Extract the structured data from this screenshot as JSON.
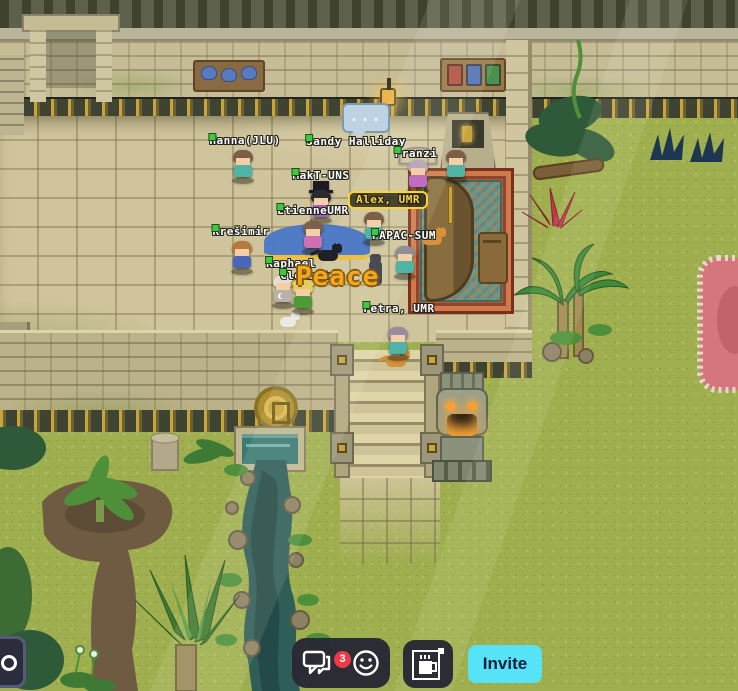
{
  "app": {
    "name": "virtual-world-map"
  },
  "scene": {
    "peace_text": "Peace",
    "typing_indicator": "...",
    "status_dot_color": "#3ec93e",
    "highlight_color": "#ffd335",
    "players": [
      {
        "name": "Hanna(JLU)",
        "lx": 245,
        "ly": 134,
        "sx": 231,
        "sy": 150,
        "hair": "#7d5f49",
        "shirt": "#4fb3a5"
      },
      {
        "name": "Sandy Halliday",
        "lx": 356,
        "ly": 135,
        "sx": 444,
        "sy": 150,
        "hair": "#7d5f49",
        "shirt": "#4fb3a5"
      },
      {
        "name": "Franzi",
        "lx": 416,
        "ly": 147,
        "sx": 406,
        "sy": 160,
        "hair": "#b9a9bb",
        "shirt": "#c06cc0",
        "acc": "umbrella"
      },
      {
        "name": "MakT-UNS",
        "lx": 321,
        "ly": 169,
        "sx": 309,
        "sy": 190,
        "hair": "#2a2a32",
        "shirt": "#a45ec2",
        "acc": "tophat"
      },
      {
        "name": "Alex, UMR",
        "lx": 388,
        "ly": 191,
        "sx": 362,
        "sy": 212,
        "hair": "#7d5f49",
        "shirt": "#4fb3a5",
        "hl": true
      },
      {
        "name": "EtienneUMR",
        "lx": 313,
        "ly": 204,
        "sx": 301,
        "sy": 221,
        "hair": "#7d5f49",
        "shirt": "#cf6fb0"
      },
      {
        "name": "Krešimir",
        "lx": 241,
        "ly": 225,
        "sx": 230,
        "sy": 241,
        "hair": "#b5793d",
        "shirt": "#4a66b8"
      },
      {
        "name": "PAPAC-SUM",
        "lx": 404,
        "ly": 229,
        "sx": 393,
        "sy": 246,
        "hair": "#8f8f95",
        "shirt": "#4fb3a5"
      },
      {
        "name": "Raphael",
        "lx": 291,
        "ly": 257,
        "sx": 271,
        "sy": 275,
        "hair": "#e4ded2",
        "shirt": "#b7b3a9",
        "acc": "moon"
      },
      {
        "name": "Clément",
        "lx": 305,
        "ly": 269,
        "sx": 291,
        "sy": 281,
        "hair": "#e3cd5d",
        "shirt": "#4f9a38",
        "acc": "strawhat"
      },
      {
        "name": "Petra, UMR",
        "lx": 399,
        "ly": 302,
        "sx": 386,
        "sy": 327,
        "hair": "#9b8ba2",
        "shirt": "#4fb3a5"
      }
    ],
    "animals": [
      {
        "type": "cat",
        "color": "#20202a",
        "x": 318,
        "y": 244
      },
      {
        "type": "cat",
        "color": "#d8913a",
        "x": 422,
        "y": 228
      },
      {
        "type": "catv",
        "color": "#4a4a52",
        "x": 369,
        "y": 260
      },
      {
        "type": "cat",
        "color": "#d8913a",
        "x": 386,
        "y": 350
      },
      {
        "type": "dog",
        "color": "#eceae2",
        "x": 280,
        "y": 312
      }
    ]
  },
  "toolbar": {
    "chat_button": {
      "icon": "chat-bubbles-icon",
      "badge": "3",
      "badge_color": "#f03848"
    },
    "emoji_button": {
      "icon": "smiley-icon"
    },
    "break_button": {
      "icon": "coffee-mug-icon"
    },
    "invite_button": {
      "label": "Invite",
      "bg": "#56e3f7",
      "text_color": "#14203a"
    },
    "partial_button": {
      "icon": "partial-circle-glyph"
    }
  }
}
